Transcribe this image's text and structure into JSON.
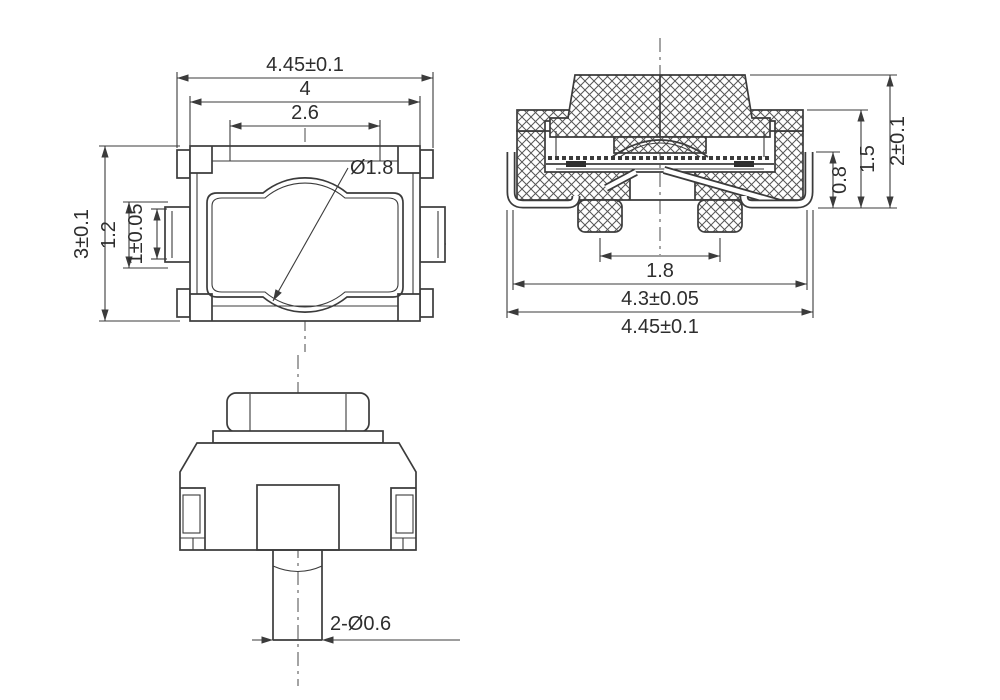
{
  "drawing": {
    "background": "#ffffff",
    "line_color": "#3b3b3b",
    "top_view": {
      "dim_overall_width": "4.45±0.1",
      "dim_body_width": "4",
      "dim_cover_width": "2.6",
      "dim_dome_diameter": "Ø1.8",
      "dim_overall_depth": "3±0.1",
      "dim_tab_outer": "1.2",
      "dim_tab_inner": "1±0.05"
    },
    "section_view": {
      "dim_terminal_height": "0.8",
      "dim_housing_height": "1.5",
      "dim_overall_height": "2±0.1",
      "dim_boss_pitch": "1.8",
      "dim_base_width": "4.3±0.05",
      "dim_overall_width": "4.45±0.1"
    },
    "front_view": {
      "dim_locating_pegs": "2-Ø0.6"
    }
  }
}
